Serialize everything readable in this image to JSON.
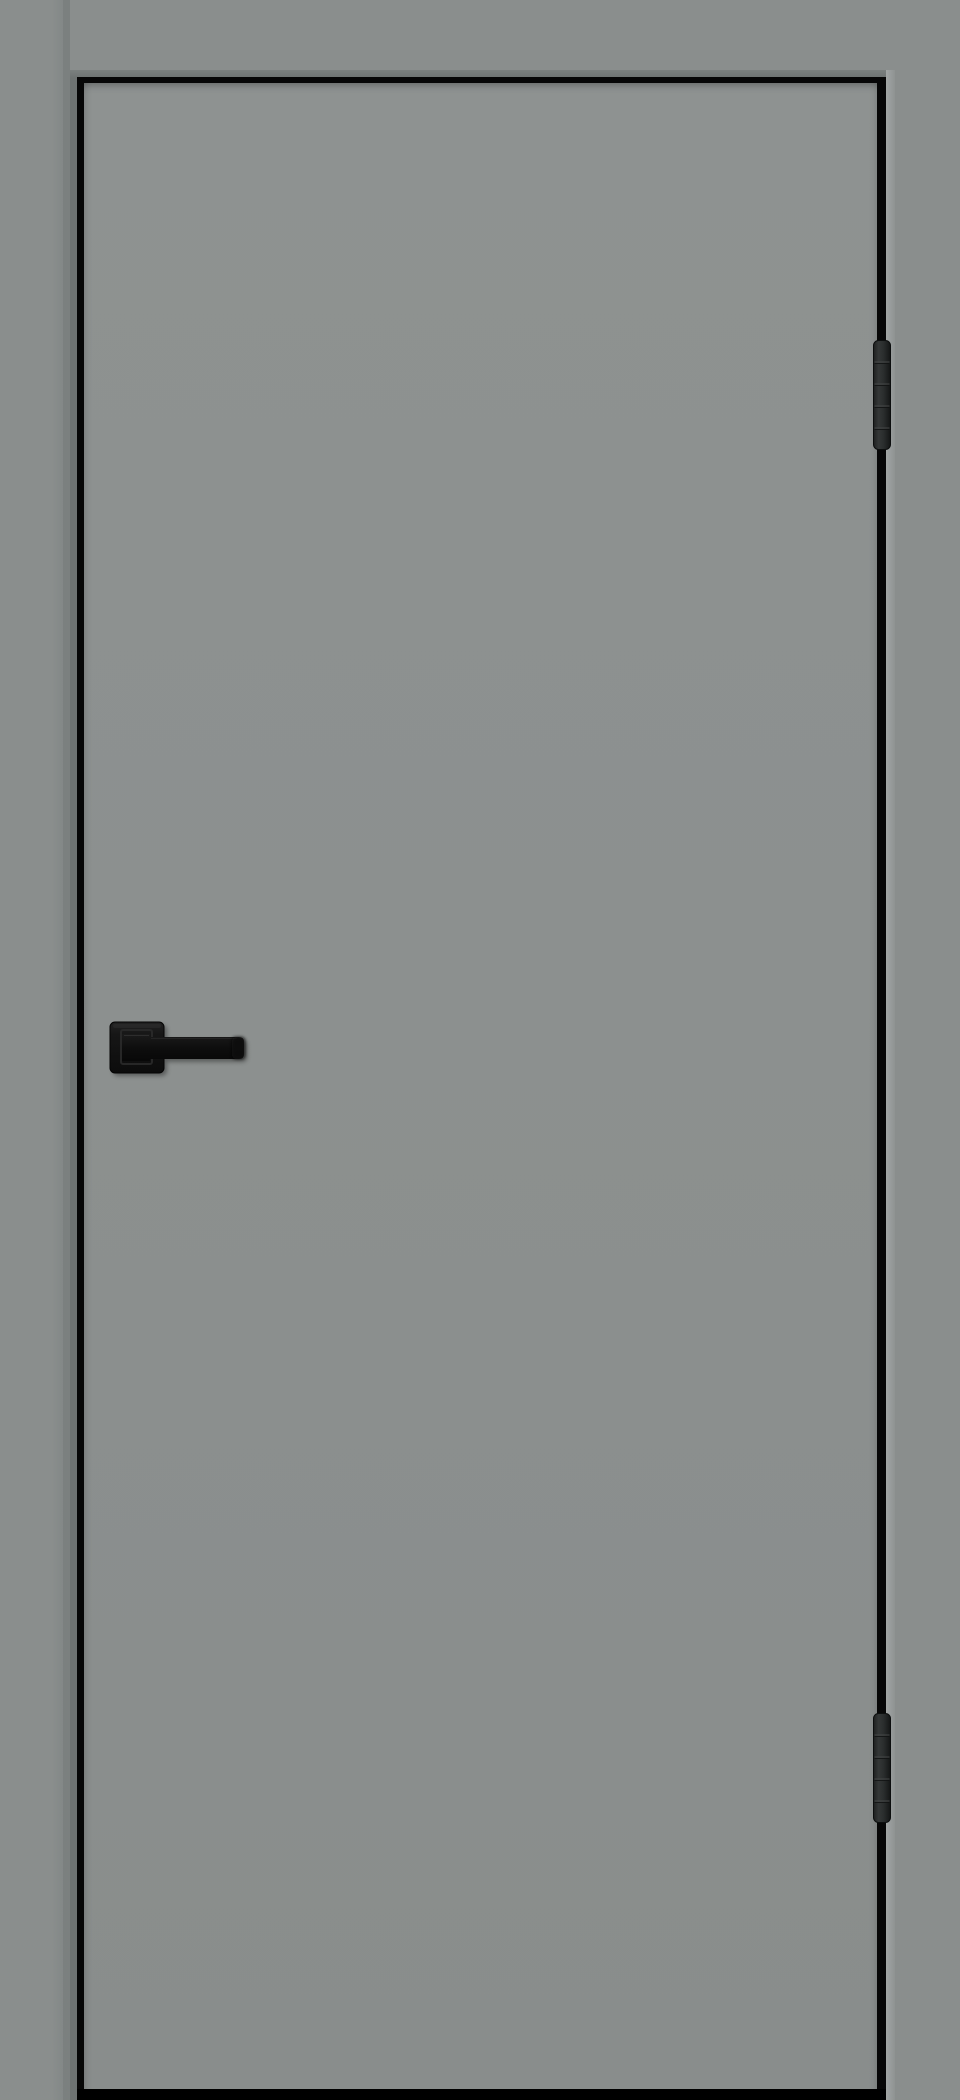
{
  "meta": {
    "type": "product-photo",
    "subject": "interior door",
    "description": "Closed flush gray interior door shown front-on, filling the whole image, surrounded by a matching gray frame with a thin black edge gap, black lever handle on the left and two black barrel hinges on the right edge"
  },
  "door": {
    "style": "flush flat slab, no glazing, no panels",
    "finish": "matte gray",
    "state": "closed",
    "handing": "hinges on right edge, handle on left side at mid-height"
  },
  "hardware": {
    "handle": {
      "type": "straight lever on square rosette",
      "color": "#111111",
      "position": "left side, mid-height",
      "lever_direction": "pointing right"
    },
    "hinges": {
      "count": 2,
      "type": "segmented barrel hinge",
      "color": "#2B2D2D",
      "positions": [
        "upper right edge",
        "lower right edge"
      ],
      "knuckle_segments": 5
    }
  },
  "colors": {
    "frame": "#8A8E8D",
    "door": "#8C908F",
    "seam_mid": "#7B807F",
    "seam_dark": "#6E7372",
    "gap_black": "#070707",
    "edge_highlight": "#A2A6A5",
    "threshold_shadow": "#000000",
    "hinge_body": "#2B2D2D",
    "handle_black": "#111111"
  },
  "labels": {
    "scene": "Gray interior door product photo",
    "frame_left": "Left door frame jamb",
    "frame_head": "Top door frame jamb",
    "frame_right": "Right door frame jamb",
    "edge_gap": "Black gap between door leaf and frame",
    "door_leaf": "Flush gray door leaf",
    "threshold": "Shadow gap under the door",
    "hinge_top": "Upper barrel hinge",
    "hinge_bottom": "Lower barrel hinge",
    "handle": "Black lever handle on square rosette"
  }
}
